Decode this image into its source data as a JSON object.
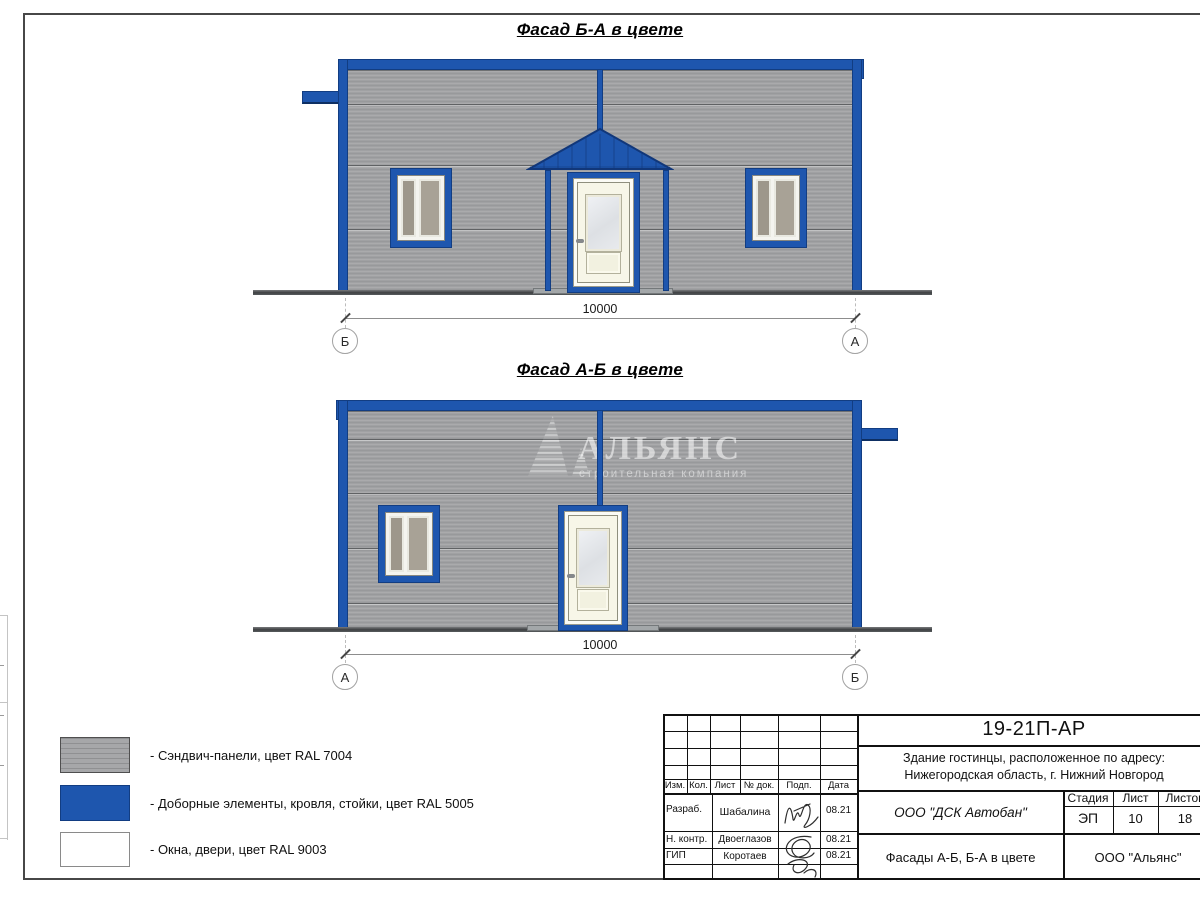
{
  "facade_top": {
    "title": "Фасад Б-А в цвете",
    "dimension": "10000",
    "axis_left": "Б",
    "axis_right": "А"
  },
  "facade_bottom": {
    "title": "Фасад А-Б в цвете",
    "dimension": "10000",
    "axis_left": "А",
    "axis_right": "Б"
  },
  "watermark": {
    "brand": "АЛЬЯНС",
    "tagline": "строительная компания"
  },
  "legend": {
    "items": [
      {
        "label": "- Сэндвич-панели, цвет RAL 7004"
      },
      {
        "label": "- Доборные элементы, кровля, стойки, цвет RAL 5005"
      },
      {
        "label": "- Окна, двери, цвет RAL 9003"
      }
    ]
  },
  "title_block": {
    "doc_number": "19-21П-АР",
    "project_address_line1": "Здание гостинцы, расположенное по адресу:",
    "project_address_line2": "Нижегородская область, г. Нижний Новгород",
    "rev_headers": [
      "Изм.",
      "Кол.",
      "Лист",
      "№ док.",
      "Подп.",
      "Дата"
    ],
    "signers": [
      {
        "role": "Разраб.",
        "name": "Шабалина",
        "date": "08.21"
      },
      {
        "role": "Н. контр.",
        "name": "Двоеглазов",
        "date": "08.21"
      },
      {
        "role": "ГИП",
        "name": "Коротаев",
        "date": "08.21"
      }
    ],
    "contractor": "ООО \"ДСК Автобан\"",
    "sheet_name": "Фасады А-Б, Б-А в цвете",
    "organization": "ООО \"Альянс\"",
    "stage_header": "Стадия",
    "sheet_header": "Лист",
    "sheets_header": "Листов",
    "stage": "ЭП",
    "sheet_number": "10",
    "sheets_total": "18"
  },
  "colors": {
    "panel_ral7004": "#a0a1a3",
    "trim_ral5005": "#1e56ae",
    "windows_ral9003": "#ffffff"
  }
}
